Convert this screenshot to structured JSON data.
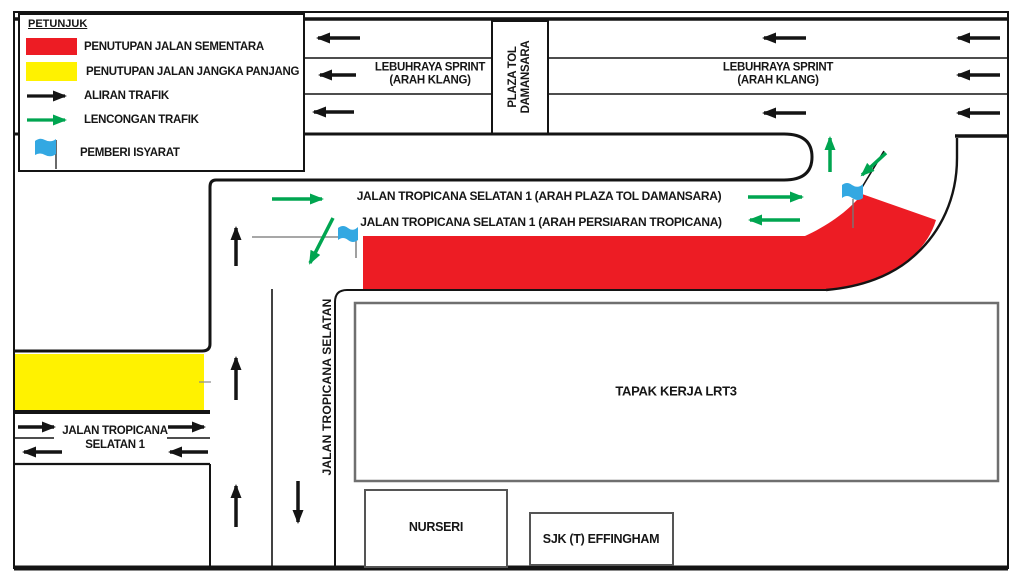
{
  "legend": {
    "title": "PETUNJUK",
    "items": [
      {
        "symbol": "red-swatch",
        "label": "PENUTUPAN JALAN SEMENTARA",
        "color": "#ed1c24"
      },
      {
        "symbol": "yellow-swatch",
        "label": "PENUTUPAN JALAN JANGKA PANJANG",
        "color": "#fff200"
      },
      {
        "symbol": "black-arrow",
        "label": "ALIRAN TRAFIK",
        "color": "#141414"
      },
      {
        "symbol": "green-arrow",
        "label": "LENCONGAN TRAFIK",
        "color": "#00a550"
      },
      {
        "symbol": "blue-flag",
        "label": "PEMBERI ISYARAT",
        "color": "#33a8e2"
      }
    ]
  },
  "roads": {
    "highway_label_left": {
      "line1": "LEBUHRAYA SPRINT",
      "line2": "(ARAH KLANG)"
    },
    "highway_label_right": {
      "line1": "LEBUHRAYA SPRINT",
      "line2": "(ARAH KLANG)"
    },
    "toll_plaza": {
      "line1": "PLAZA TOL",
      "line2": "DAMANSARA"
    },
    "jts1_to_plaza": "JALAN TROPICANA SELATAN 1 (ARAH PLAZA TOL DAMANSARA)",
    "jts1_to_persiaran": "JALAN TROPICANA SELATAN 1 (ARAH PERSIARAN TROPICANA)",
    "vertical_road": "JALAN TROPICANA SELATAN",
    "left_road": {
      "line1": "JALAN TROPICANA",
      "line2": "SELATAN 1"
    }
  },
  "sites": {
    "lrt3": "TAPAK KERJA LRT3",
    "nursery": "NURSERI",
    "school": "SJK (T) EFFINGHAM"
  },
  "colors": {
    "temporary_closure": "#ed1c24",
    "longterm_closure": "#fff200",
    "traffic_flow": "#141414",
    "traffic_diversion": "#00a550",
    "flagman_flag": "#33a8e2"
  }
}
